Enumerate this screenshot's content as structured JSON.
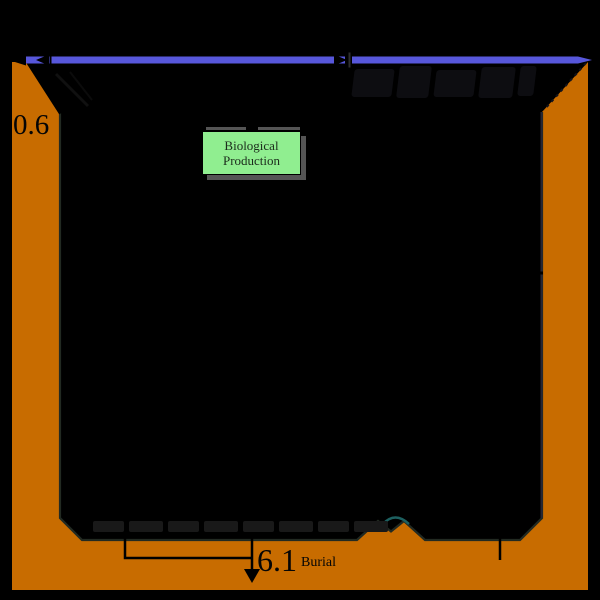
{
  "canvas": {
    "width": 600,
    "height": 600,
    "background": "#000000"
  },
  "colors": {
    "sediment": "#C86C00",
    "surface_line": "#5757DB",
    "production_fill": "#90EE90",
    "production_border": "#000000",
    "production_shadow": "#555555",
    "hydrothermal_arc": "#1D6060",
    "ink": "#000000"
  },
  "labels": {
    "left_flux": "0.6",
    "burial_value": "6.1",
    "burial_caption": "Burial",
    "production_box": "Biological Production"
  }
}
